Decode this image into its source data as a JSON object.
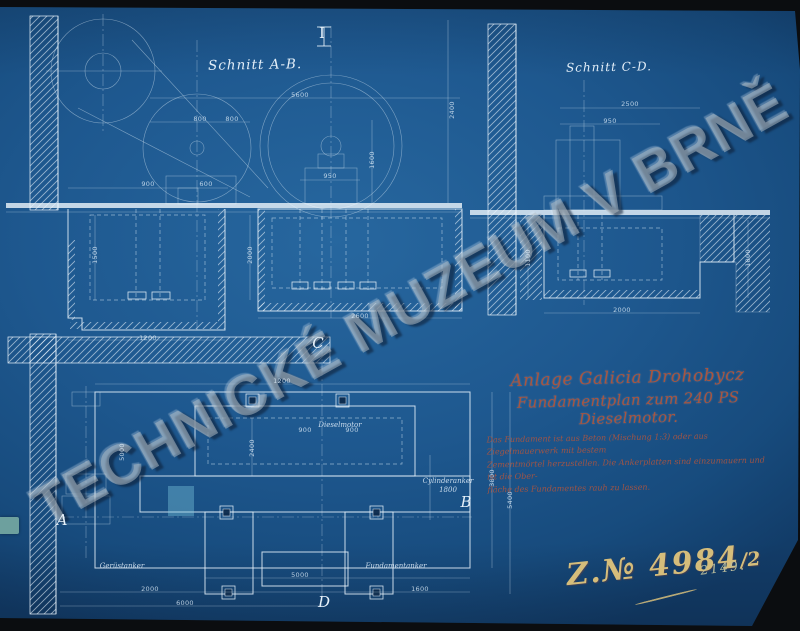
{
  "sections": {
    "section_ab": {
      "title": "Schnitt A-B.",
      "beam_mark": "I"
    },
    "section_cd": {
      "title": "Schnitt C-D."
    },
    "plan": {
      "markers": [
        {
          "text": "A",
          "x": 62,
          "y": 520
        },
        {
          "text": "B",
          "x": 466,
          "y": 502
        },
        {
          "text": "C",
          "x": 318,
          "y": 343
        },
        {
          "text": "D",
          "x": 324,
          "y": 602
        }
      ],
      "labels": [
        {
          "text": "Gerüstanker",
          "x": 122,
          "y": 566
        },
        {
          "text": "Fundamentanker",
          "x": 396,
          "y": 566
        },
        {
          "text": "Cylinderanker",
          "x": 448,
          "y": 481
        },
        {
          "text": "1800",
          "x": 448,
          "y": 490
        },
        {
          "text": "Dieselmotor",
          "x": 340,
          "y": 425
        }
      ]
    }
  },
  "title_block": {
    "line1": "Anlage Galicia Drohobycz",
    "line2": "Fundamentplan zum 240 PS Dieselmotor.",
    "notes": [
      "Das Fundament ist aus Beton (Mischung 1:3) oder aus Ziegelmauerwerk mit bestem",
      "Zementmörtel herzustellen. Die Ankerplatten sind einzumauern und ist die Ober-",
      "fläche des Fundamentes rauh zu lassen."
    ]
  },
  "stamps": {
    "watermark": "TECHNICKÉ MUZEUM V BRNĚ",
    "drawing_number": "Z.№ 4984",
    "fraction": "/2",
    "aux_number": "2149."
  },
  "colors": {
    "paper_blue": "#1e588f",
    "ink_white": "#e9f3fb",
    "red_ink": "#a9553f",
    "yellow_ink": "#d5bd7b",
    "watermark_gray": "#b2bec6",
    "tab_teal": "#6da09e"
  },
  "dimensions": [
    {
      "text": "5600",
      "x": 300,
      "y": 95,
      "rot": 0
    },
    {
      "text": "800",
      "x": 200,
      "y": 119,
      "rot": 0
    },
    {
      "text": "800",
      "x": 232,
      "y": 119,
      "rot": 0
    },
    {
      "text": "900",
      "x": 148,
      "y": 184,
      "rot": 0
    },
    {
      "text": "600",
      "x": 206,
      "y": 184,
      "rot": 0
    },
    {
      "text": "950",
      "x": 330,
      "y": 176,
      "rot": 0
    },
    {
      "text": "2400",
      "x": 452,
      "y": 110,
      "rot": 90
    },
    {
      "text": "1600",
      "x": 372,
      "y": 160,
      "rot": 90
    },
    {
      "text": "1500",
      "x": 95,
      "y": 255,
      "rot": 90
    },
    {
      "text": "2000",
      "x": 250,
      "y": 255,
      "rot": 90
    },
    {
      "text": "1200",
      "x": 148,
      "y": 338,
      "rot": 0
    },
    {
      "text": "2600",
      "x": 360,
      "y": 316,
      "rot": 0
    },
    {
      "text": "2500",
      "x": 630,
      "y": 104,
      "rot": 0
    },
    {
      "text": "950",
      "x": 610,
      "y": 121,
      "rot": 0
    },
    {
      "text": "1800",
      "x": 748,
      "y": 258,
      "rot": 90
    },
    {
      "text": "1100",
      "x": 528,
      "y": 258,
      "rot": 90
    },
    {
      "text": "2000",
      "x": 622,
      "y": 310,
      "rot": 0
    },
    {
      "text": "1200",
      "x": 282,
      "y": 381,
      "rot": 0
    },
    {
      "text": "900",
      "x": 305,
      "y": 430,
      "rot": 0
    },
    {
      "text": "900",
      "x": 352,
      "y": 430,
      "rot": 0
    },
    {
      "text": "2400",
      "x": 252,
      "y": 448,
      "rot": 90
    },
    {
      "text": "5000",
      "x": 122,
      "y": 452,
      "rot": 90
    },
    {
      "text": "3800",
      "x": 492,
      "y": 478,
      "rot": 90
    },
    {
      "text": "5400",
      "x": 510,
      "y": 500,
      "rot": 90
    },
    {
      "text": "2000",
      "x": 150,
      "y": 589,
      "rot": 0
    },
    {
      "text": "5000",
      "x": 300,
      "y": 575,
      "rot": 0
    },
    {
      "text": "1600",
      "x": 420,
      "y": 589,
      "rot": 0
    },
    {
      "text": "6000",
      "x": 185,
      "y": 603,
      "rot": 0
    }
  ]
}
